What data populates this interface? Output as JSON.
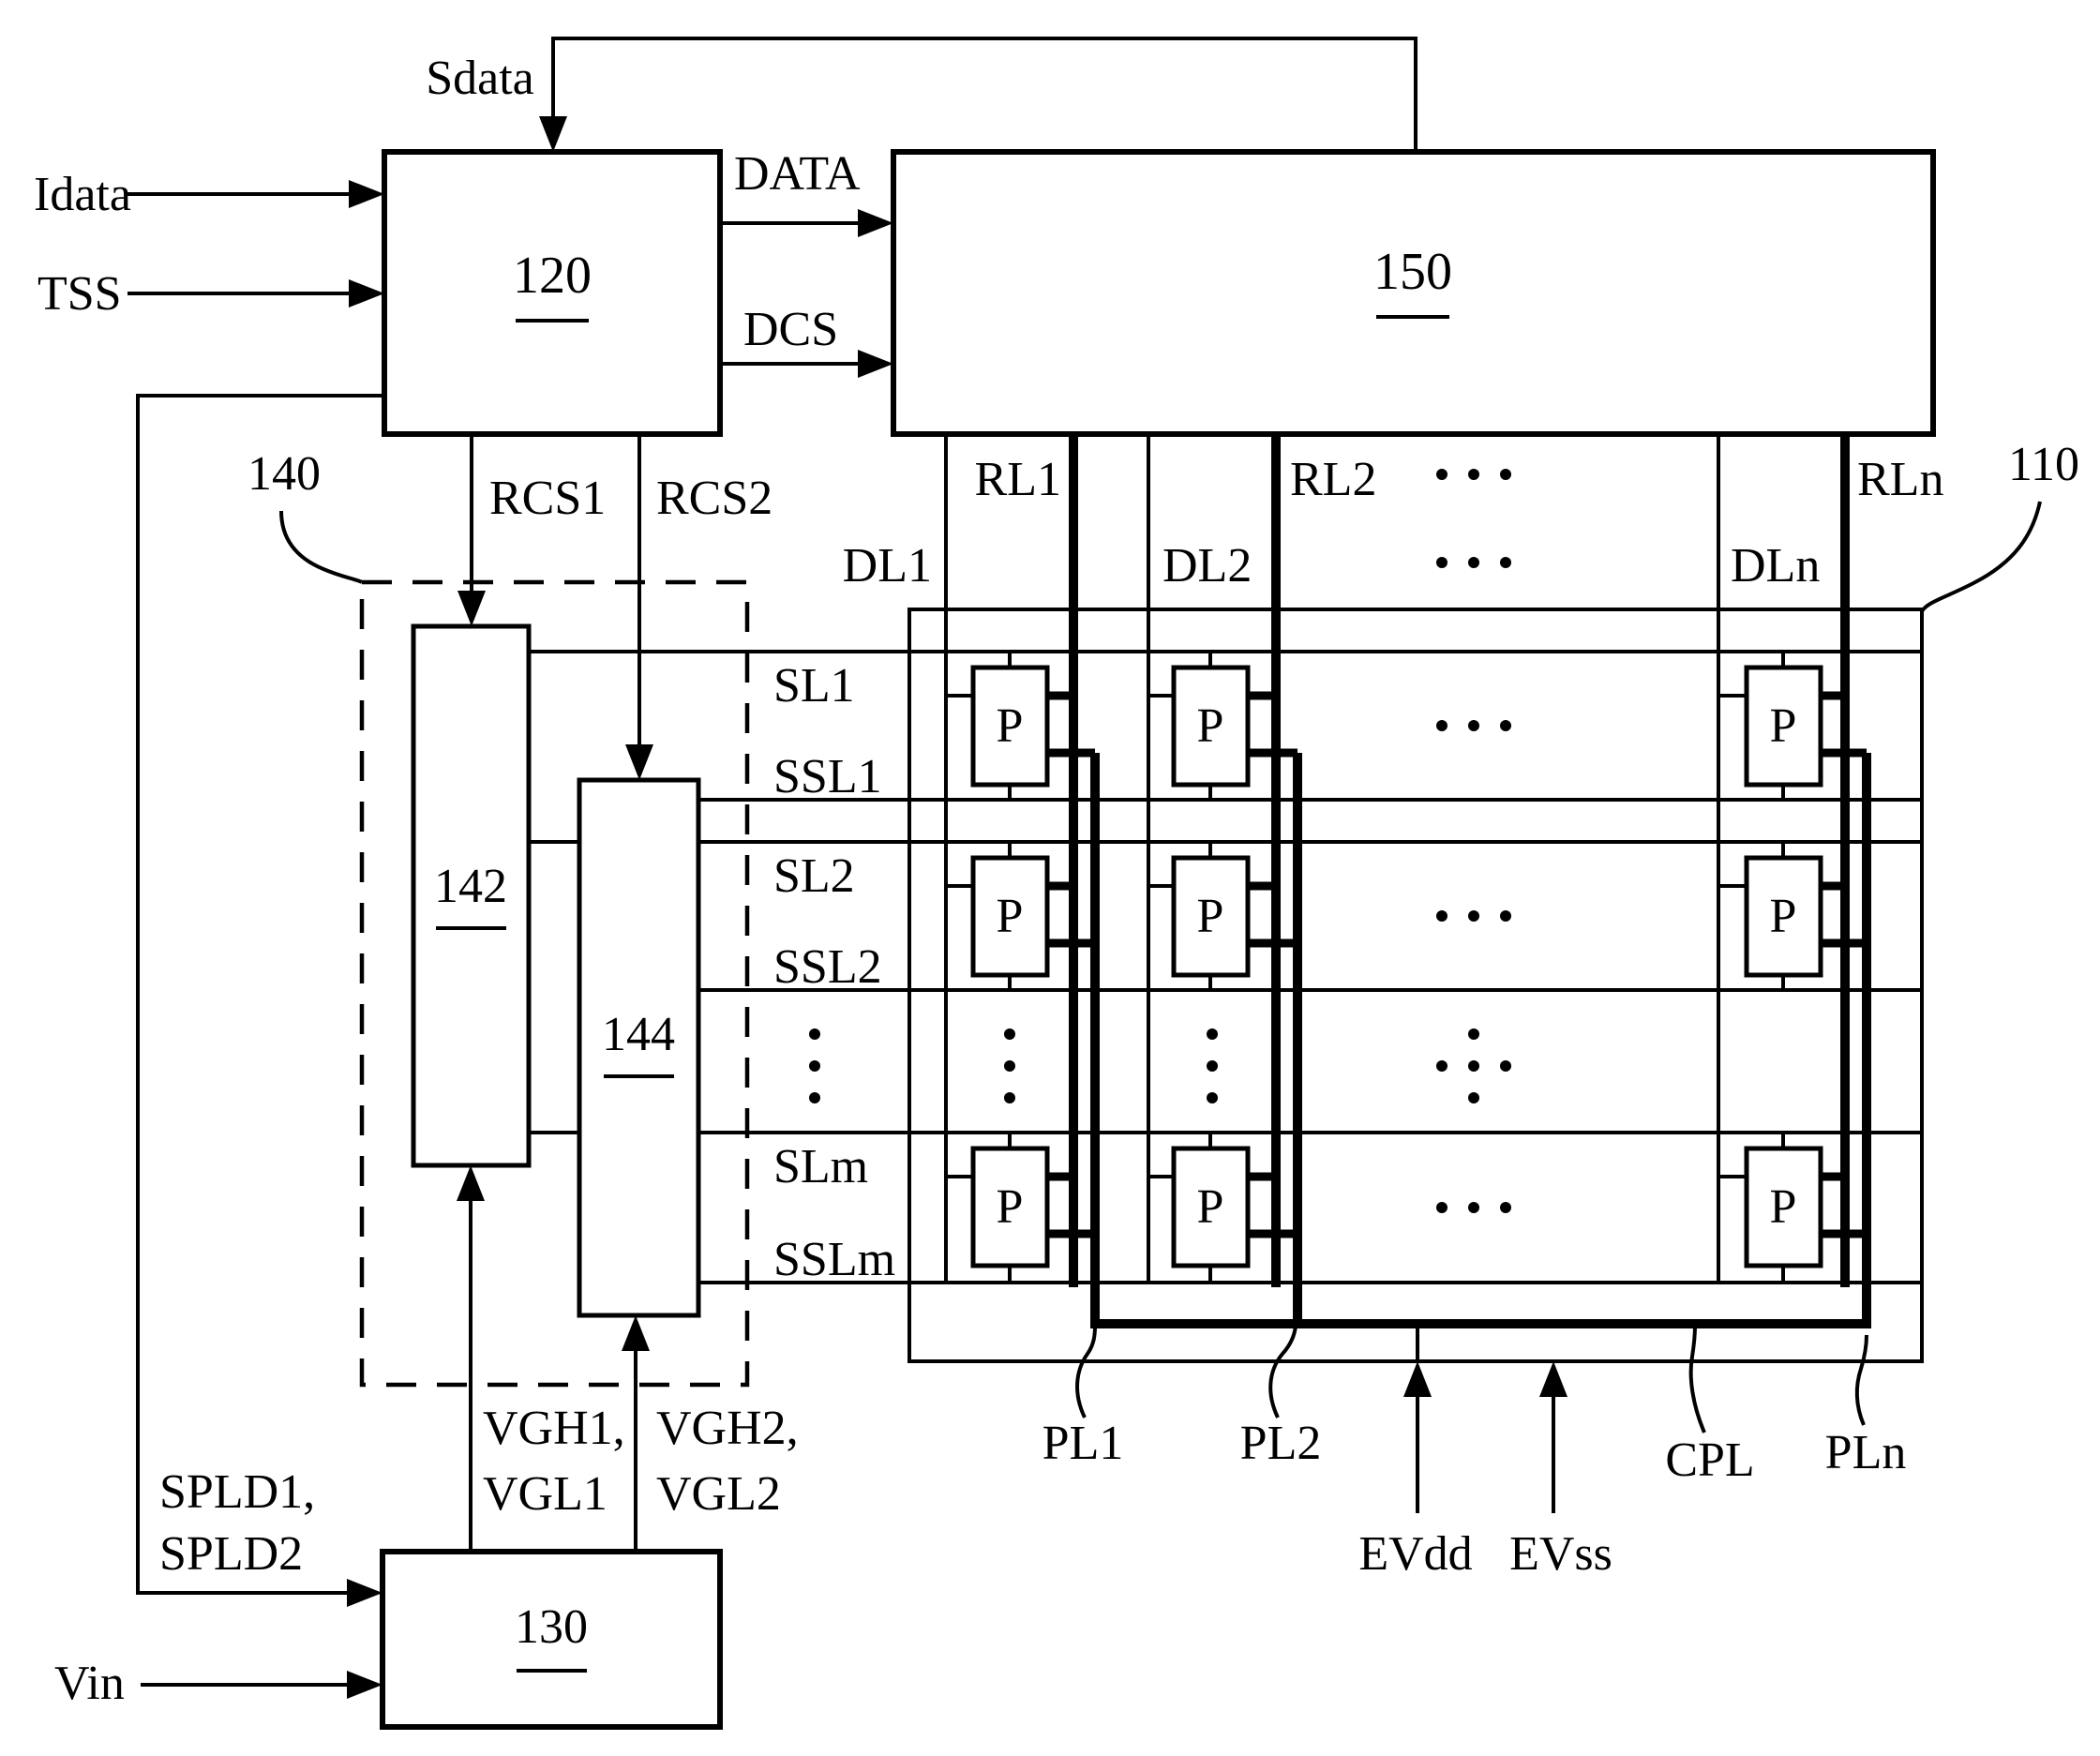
{
  "figure": {
    "ink_color": "#000000",
    "paper_color": "#ffffff"
  },
  "blocks": {
    "controller": "120",
    "data_driver": "150",
    "gate_driver_unit": "140",
    "first_gate_driver": "142",
    "second_gate_driver": "144",
    "power_supply": "130",
    "display_panel": "110"
  },
  "signals": {
    "sdata": "Sdata",
    "idata": "Idata",
    "tss": "TSS",
    "data": "DATA",
    "dcs": "DCS",
    "rcs1": "RCS1",
    "rcs2": "RCS2",
    "spld_line1": "SPLD1,",
    "spld_line2": "SPLD2",
    "vin": "Vin",
    "vgh1": "VGH1,",
    "vgl1": "VGL1",
    "vgh2": "VGH2,",
    "vgl2": "VGL2"
  },
  "panel": {
    "pixel": "P",
    "rows": [
      {
        "scan_line": "SL1",
        "sensing_scan_line": "SSL1"
      },
      {
        "scan_line": "SL2",
        "sensing_scan_line": "SSL2"
      },
      {
        "scan_line": "SLm",
        "sensing_scan_line": "SSLm"
      }
    ],
    "columns": [
      {
        "data_line": "DL1",
        "readout_line": "RL1"
      },
      {
        "data_line": "DL2",
        "readout_line": "RL2"
      },
      {
        "data_line": "DLn",
        "readout_line": "RLn"
      }
    ],
    "power_lines": {
      "pl1": "PL1",
      "pl2": "PL2",
      "cpl": "CPL",
      "pln": "PLn"
    },
    "supplies": {
      "evdd": "EVdd",
      "evss": "EVss"
    }
  }
}
